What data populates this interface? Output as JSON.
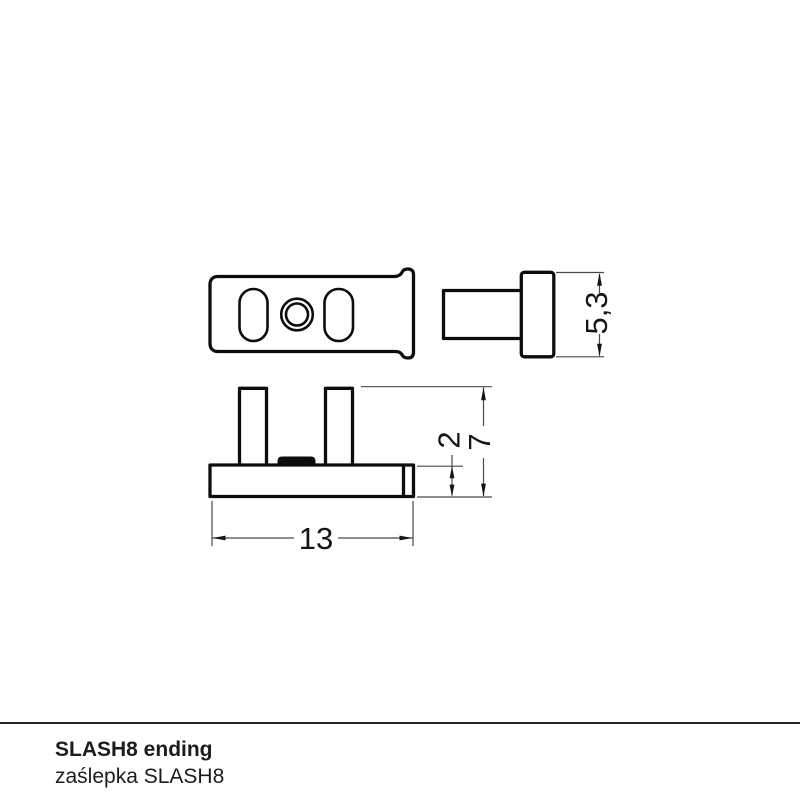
{
  "colors": {
    "ink": "#0d0d0d",
    "thin_line": "#4a4a4a",
    "background": "#ffffff"
  },
  "drawing": {
    "dim_flange_height": "5,3",
    "dim_clip_height": "2",
    "dim_total_height": "7",
    "dim_width": "13"
  },
  "footer": {
    "title": "SLASH8 ending",
    "subtitle": "zaślepka SLASH8"
  }
}
